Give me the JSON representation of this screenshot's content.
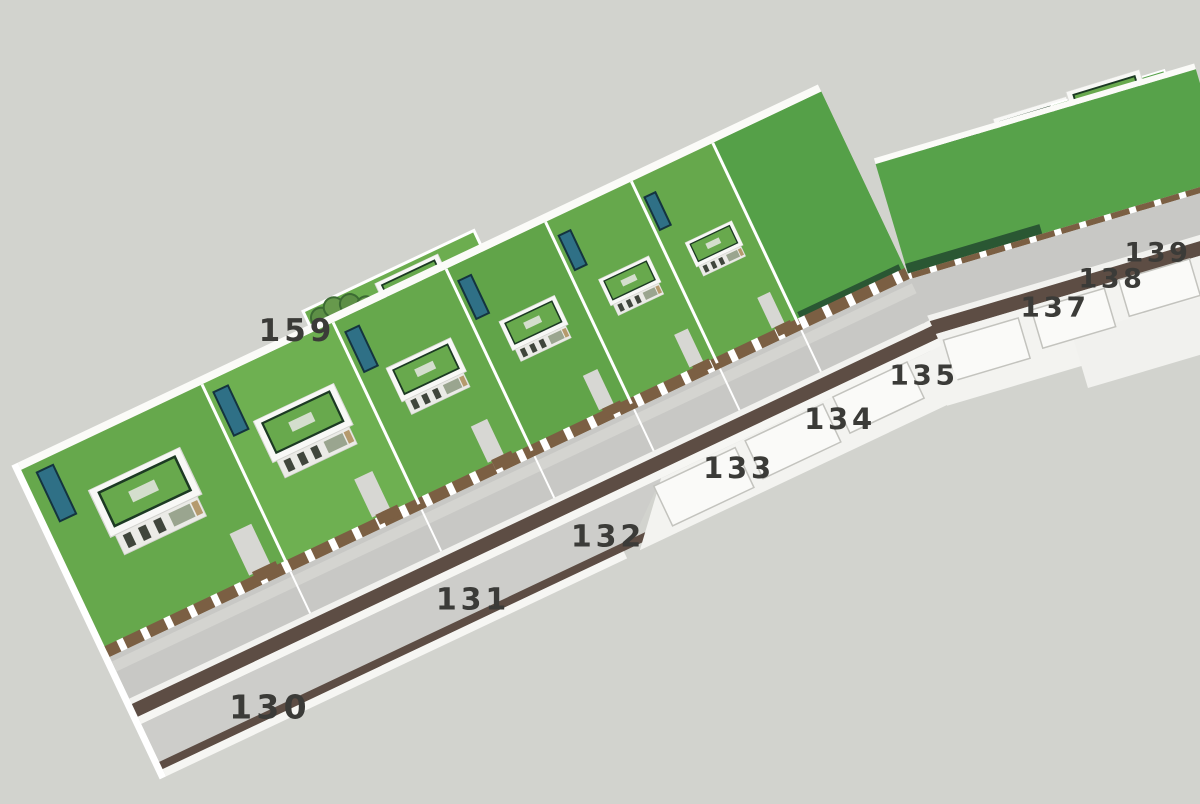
{
  "scene": {
    "description": "3D aerial rendering of a strip of modern flat-roof villas with roof gardens and pools along a diagonal street, lot numbers painted beside the road",
    "background_color": "#d2d3ce",
    "label_color": "#3b3b38",
    "palette": {
      "lawn": "#6cad4f",
      "lawn_dark": "#55a048",
      "hedge": "#2a5733",
      "tree": "#5d8f46",
      "pool_water": "#2f7086",
      "pool_frame": "#14343f",
      "road_stripe_brown": "#5d4d44",
      "street_concrete": "#c8c8c5",
      "asphalt": "#cdcdca",
      "sidewalk_white": "#f3f3f0",
      "wall_white": "#ffffff",
      "fence_wood": "#7b5f43",
      "roof_slab": "#f8f8f6",
      "roof_garden_frame": "#1c3a23",
      "house_body": "#ebebe7",
      "window_glass": "#40463c",
      "text": "#3b3b38"
    },
    "lot_labels": [
      {
        "id": "130",
        "x": 270,
        "y": 707,
        "size": 33
      },
      {
        "id": "131",
        "x": 473,
        "y": 600,
        "size": 30
      },
      {
        "id": "132",
        "x": 608,
        "y": 537,
        "size": 30
      },
      {
        "id": "133",
        "x": 739,
        "y": 468,
        "size": 29
      },
      {
        "id": "134",
        "x": 840,
        "y": 419,
        "size": 29
      },
      {
        "id": "135",
        "x": 924,
        "y": 375,
        "size": 28
      },
      {
        "id": "137",
        "x": 1055,
        "y": 307,
        "size": 28
      },
      {
        "id": "138",
        "x": 1112,
        "y": 279,
        "size": 27
      },
      {
        "id": "139",
        "x": 1158,
        "y": 253,
        "size": 27
      },
      {
        "id": "159",
        "x": 297,
        "y": 331,
        "size": 31
      }
    ]
  }
}
